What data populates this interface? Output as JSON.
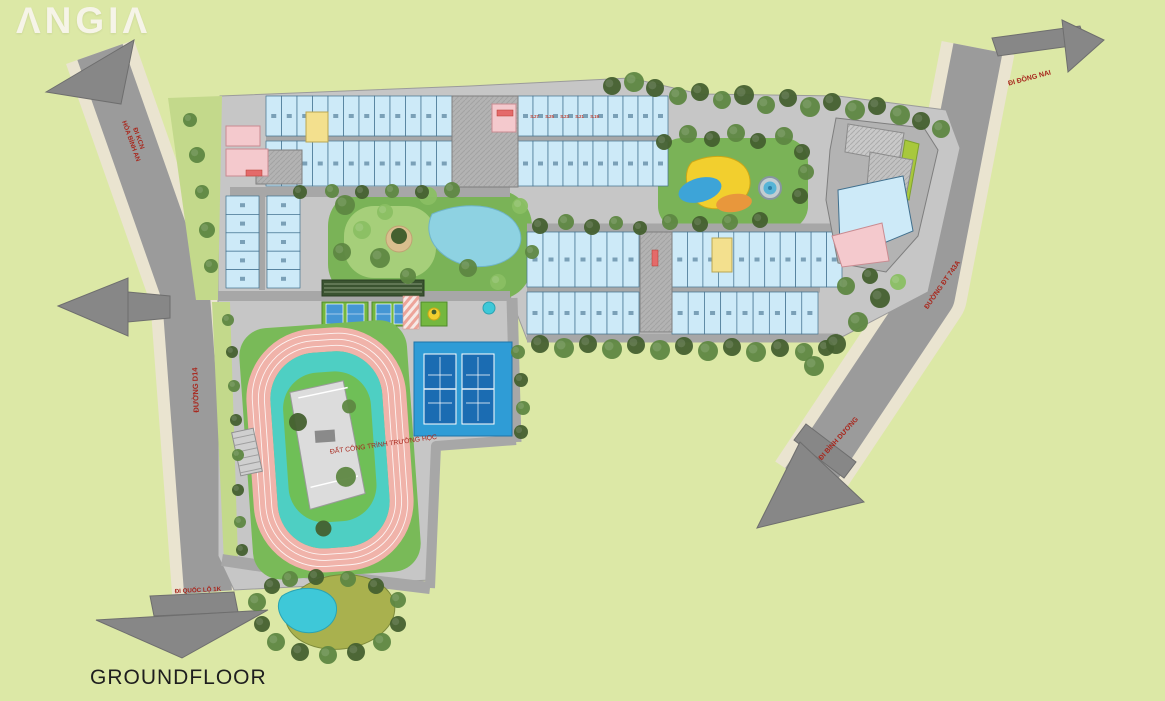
{
  "logo": {
    "text": "ΛNGIΛ"
  },
  "caption": {
    "text": "GROUNDFLOOR"
  },
  "road_labels": {
    "kcn_line1": "ĐI KCN",
    "kcn_line2": "HÓA BÌNH AN",
    "d14": "ĐƯỜNG D14",
    "quoc_lo": "ĐI QUỐC LỘ 1K",
    "dong_nai": "ĐI ĐỒNG NAI",
    "dt743": "ĐƯỜNG ĐT 743A",
    "binh_duong": "ĐI BÌNH DƯƠNG"
  },
  "area_labels": {
    "school": "ĐẤT CÔNG TRÌNH TRƯỜNG HỌC"
  },
  "unit_labels": [
    "S.27",
    "S.25",
    "S.23",
    "S.21",
    "S.19"
  ],
  "features": [
    "shophouse-rows",
    "central-park",
    "children-playground",
    "fountain",
    "tennis-courts",
    "multi-sport-courts",
    "running-track",
    "school-site",
    "landscape-pond",
    "commercial-block"
  ],
  "colors": {
    "grass": "#dce8a6",
    "road": "#9b9b9b",
    "arrow_gray": "#878787",
    "sidewalk": "#eae4d0",
    "platform": "#c6c6c6",
    "lane": "#a7a7a7",
    "green_strip": "#c3d98b",
    "building_fill": "#cdeaf8",
    "building_stroke": "#41708e",
    "core_gray": "#b3b3b3",
    "accent_pink": "#f4c9cd",
    "accent_yellow": "#f3e08e",
    "label_red": "#a8281e",
    "unit_label": "#c0392b",
    "tree_dark": "#44602f",
    "tree_mid": "#5e8742",
    "tree_light": "#8abf63",
    "park_green": "#7ab357",
    "lawn_light": "#a6cf7a",
    "park_pond": "#8ed2e2",
    "sand": "#d9bf8e",
    "play_yellow": "#f2cf2e",
    "play_blue": "#3da4d8",
    "play_orange": "#e8973c",
    "pad_green": "#74b73f",
    "small_court_blue": "#4596d4",
    "tennis_pad": "#2f9cd6",
    "tennis_court": "#1b6cb2",
    "track_pink": "#f0b3aa",
    "field_outer": "#79ba58",
    "field_teal": "#4ecfc3",
    "field_green": "#6fbf57",
    "pond_cyan": "#3ec8d8",
    "pond_olive": "#a9b14e",
    "lime_strip": "#a8c83c",
    "school_bldg": "#dcdcdc"
  }
}
